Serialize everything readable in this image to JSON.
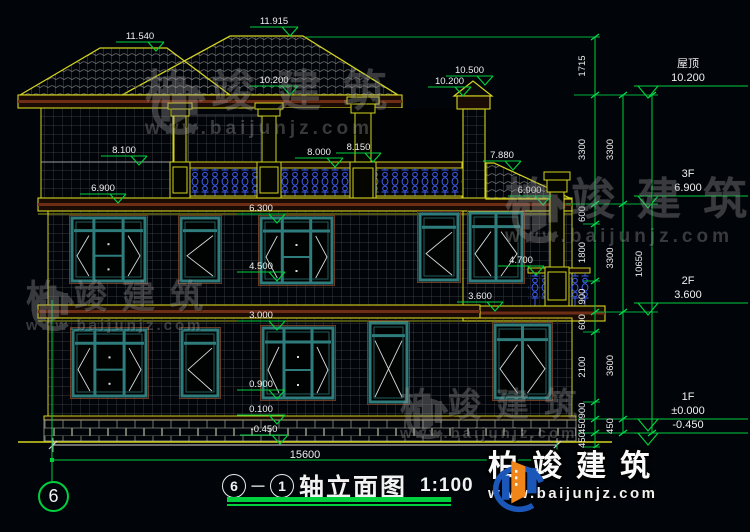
{
  "watermark": {
    "brand": "柏竣建筑",
    "url": "www.baijunjz.com"
  },
  "logo": {
    "brand": "柏竣建筑",
    "url": "www.baijunjz.com"
  },
  "title": {
    "axis_from": "6",
    "dash": "－",
    "axis_to": "1",
    "name": "轴立面图",
    "scale": "1:100"
  },
  "axis_bubble": "6",
  "bottom_dim": "15600",
  "colors": {
    "dim_green": "#00cf3e",
    "line_yellow": "#d4d41e",
    "text_white": "#f0f0f0",
    "window_teal": "#2e7c7c",
    "baluster_blue": "#3f5df2"
  },
  "drawing": {
    "markers": [
      {
        "label": "11.540",
        "x1": 116,
        "x2": 164,
        "y": 42
      },
      {
        "label": "11.915",
        "x1": 250,
        "x2": 298,
        "y": 27
      },
      {
        "label": "10.200",
        "x1": 250,
        "x2": 298,
        "y": 86
      },
      {
        "label": "10.500",
        "x1": 446,
        "x2": 493,
        "y": 76
      },
      {
        "label": "10.200",
        "x1": 428,
        "x2": 471,
        "y": 87
      },
      {
        "label": "8.100",
        "x1": 101,
        "x2": 147,
        "y": 156
      },
      {
        "label": "8.000",
        "x1": 295,
        "x2": 343,
        "y": 158
      },
      {
        "label": "8.150",
        "x1": 336,
        "x2": 381,
        "y": 153
      },
      {
        "label": "7.880",
        "x1": 483,
        "x2": 521,
        "y": 161
      },
      {
        "label": "6.900",
        "x1": 80,
        "x2": 126,
        "y": 194
      },
      {
        "label": "6.900",
        "x1": 508,
        "x2": 551,
        "y": 196
      },
      {
        "label": "6.300",
        "x1": 237,
        "x2": 285,
        "y": 214
      },
      {
        "label": "4.500",
        "x1": 237,
        "x2": 285,
        "y": 272
      },
      {
        "label": "4.700",
        "x1": 498,
        "x2": 544,
        "y": 266
      },
      {
        "label": "3.600",
        "x1": 457,
        "x2": 503,
        "y": 302
      },
      {
        "label": "3.000",
        "x1": 237,
        "x2": 285,
        "y": 321
      },
      {
        "label": "0.900",
        "x1": 237,
        "x2": 285,
        "y": 390
      },
      {
        "label": "0.100",
        "x1": 237,
        "x2": 285,
        "y": 415
      },
      {
        "label": "-0.450",
        "x1": 240,
        "x2": 288,
        "y": 435
      }
    ],
    "right_levels": [
      {
        "name": "屋顶",
        "value": "10.200",
        "y": 86
      },
      {
        "name": "3F",
        "value": "6.900",
        "y": 196
      },
      {
        "name": "2F",
        "value": "3.600",
        "y": 303
      },
      {
        "name": "1F",
        "value": "±0.000",
        "y": 419
      },
      {
        "name": "",
        "value": "-0.450",
        "y": 433
      }
    ],
    "dim_columns": [
      {
        "x": 595,
        "label_x": 585,
        "boundaries": [
          37,
          95,
          204,
          224,
          281,
          312,
          332,
          402,
          419,
          433,
          447
        ],
        "labels": [
          "1715",
          "3300",
          "600",
          "1800",
          "900",
          "600",
          "2100",
          "900",
          "450",
          "450"
        ]
      },
      {
        "x": 623,
        "label_x": 613,
        "boundaries": [
          95,
          204,
          312,
          419,
          433
        ],
        "labels": [
          "3300",
          "3300",
          "3600",
          "450"
        ]
      },
      {
        "x": 652,
        "label_x": 642,
        "boundaries": [
          95,
          433
        ],
        "labels": [
          "10650"
        ]
      }
    ],
    "ext_lines": [
      {
        "y": 37,
        "x1": 305,
        "x2": 600
      },
      {
        "y": 95,
        "x1": 574,
        "x2": 658
      },
      {
        "y": 204,
        "x1": 566,
        "x2": 658
      },
      {
        "y": 224,
        "x1": 583,
        "x2": 600
      },
      {
        "y": 281,
        "x1": 583,
        "x2": 600
      },
      {
        "y": 312,
        "x1": 596,
        "x2": 658
      },
      {
        "y": 332,
        "x1": 583,
        "x2": 600
      },
      {
        "y": 402,
        "x1": 583,
        "x2": 600
      },
      {
        "y": 419,
        "x1": 578,
        "x2": 658
      },
      {
        "y": 433,
        "x1": 578,
        "x2": 658
      },
      {
        "y": 447,
        "x1": 583,
        "x2": 600
      }
    ]
  }
}
